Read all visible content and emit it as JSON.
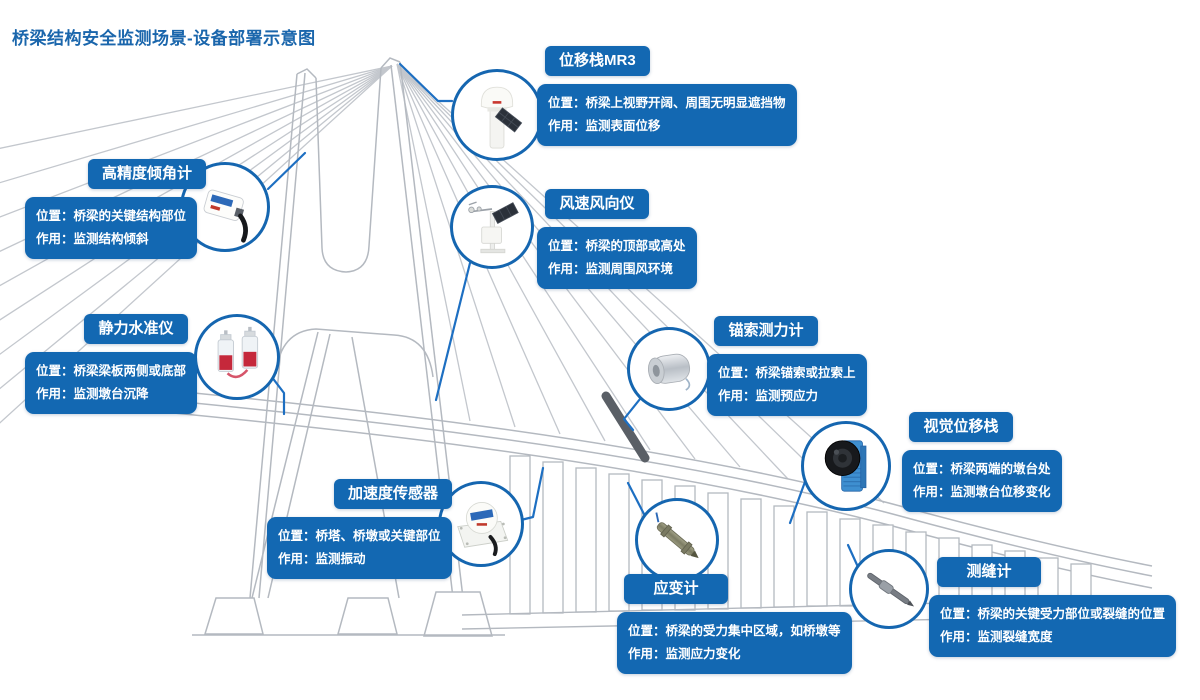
{
  "page": {
    "title": "桥梁结构安全监测场景-设备部署示意图"
  },
  "colors": {
    "accent_blue": "#1368B2",
    "connector_blue": "#1D6FC2",
    "line_gray": "#BDC1C7",
    "cable_highlight_dark": "#5A5F66",
    "title_blue": "#1A66AC",
    "text_white": "#FFFFFF"
  },
  "devices": [
    {
      "id": "displacement-station",
      "name": "位移栈MR3",
      "position": "位置：桥梁上视野开阔、周围无明显遮挡物",
      "function": "作用：监测表面位移",
      "icon": "gnss-displacement-station-icon"
    },
    {
      "id": "tiltmeter",
      "name": "高精度倾角计",
      "position": "位置：桥梁的关键结构部位",
      "function": "作用：监测结构倾斜",
      "icon": "tiltmeter-icon"
    },
    {
      "id": "anemometer",
      "name": "风速风向仪",
      "position": "位置：桥梁的顶部或高处",
      "function": "作用：监测周围风环境",
      "icon": "weather-station-icon"
    },
    {
      "id": "hydrostatic-level",
      "name": "静力水准仪",
      "position": "位置：桥梁梁板两侧或底部",
      "function": "作用：监测墩台沉降",
      "icon": "hydrostatic-level-icon"
    },
    {
      "id": "cable-load-cell",
      "name": "锚索测力计",
      "position": "位置：桥梁锚索或拉索上",
      "function": "作用：监测预应力",
      "icon": "anchor-load-cell-icon"
    },
    {
      "id": "vision-station",
      "name": "视觉位移栈",
      "position": "位置：桥梁两端的墩台处",
      "function": "作用：监测墩台位移变化",
      "icon": "vision-camera-icon"
    },
    {
      "id": "accelerometer",
      "name": "加速度传感器",
      "position": "位置：桥塔、桥墩或关键部位",
      "function": "作用：监测振动",
      "icon": "accelerometer-icon"
    },
    {
      "id": "strain-gauge",
      "name": "应变计",
      "position": "位置：桥梁的受力集中区域，如桥墩等",
      "function": "作用：监测应力变化",
      "icon": "strain-gauge-icon"
    },
    {
      "id": "crack-meter",
      "name": "测缝计",
      "position": "位置：桥梁的关键受力部位或裂缝的位置",
      "function": "作用：监测裂缝宽度",
      "icon": "crack-meter-icon"
    }
  ]
}
